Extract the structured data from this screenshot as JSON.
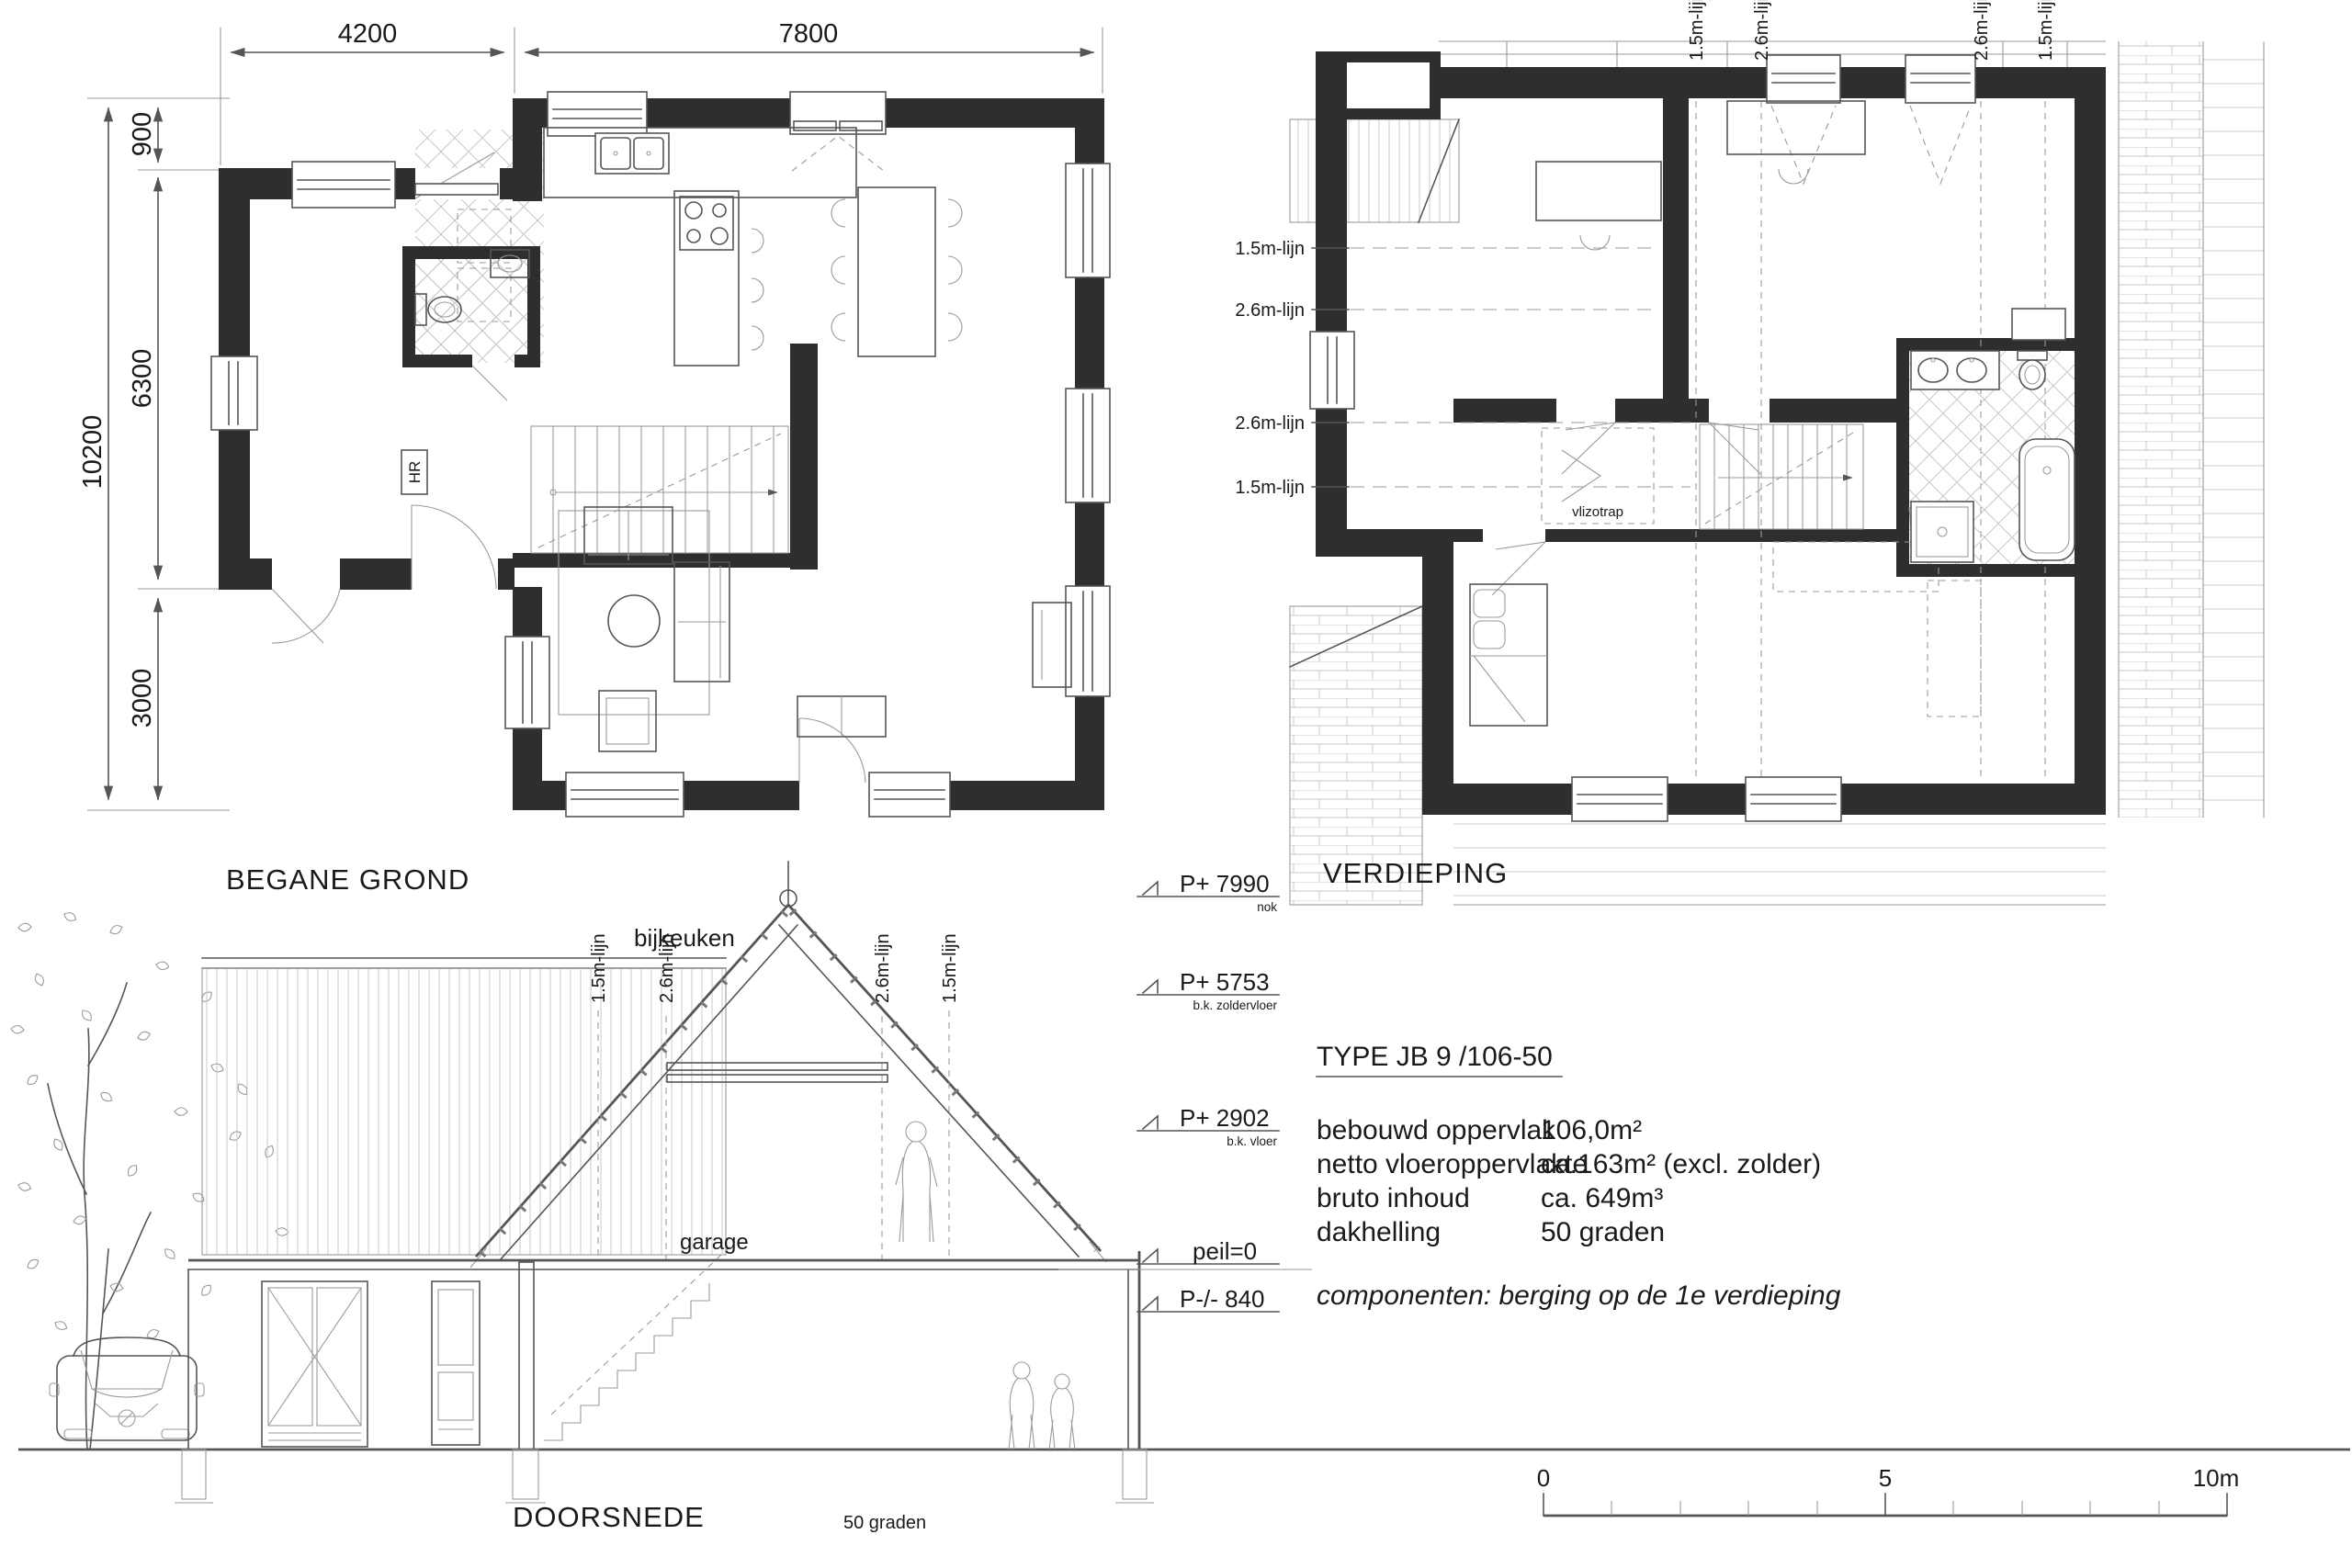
{
  "ground_floor": {
    "title": "BEGANE GROND",
    "dim_top_left": "4200",
    "dim_top_right": "7800",
    "dim_left_total": "10200",
    "dim_left_segments": [
      "900",
      "6300",
      "3000"
    ],
    "hr_label": "HR"
  },
  "first_floor": {
    "title": "VERDIEPING",
    "vlizotrap_label": "vlizotrap",
    "line_labels_left": [
      "1.5m-lijn",
      "2.6m-lijn",
      "2.6m-lijn",
      "1.5m-lijn"
    ],
    "line_labels_top": [
      "1.5m-lijn",
      "2.6m-lijn",
      "2.6m-lijn",
      "1.5m-lijn"
    ]
  },
  "section": {
    "title": "DOORSNEDE",
    "bijkeuken_label": "bijkeuken",
    "garage_label": "garage",
    "roof_pitch_label": "50 graden",
    "line_labels": [
      "1.5m-lijn",
      "2.6m-lijn",
      "2.6m-lijn",
      "1.5m-lijn"
    ]
  },
  "elevation_markers": [
    {
      "value": "P+ 7990",
      "sub": "nok"
    },
    {
      "value": "P+ 5753",
      "sub": "b.k. zoldervloer"
    },
    {
      "value": "P+ 2902",
      "sub": "b.k. vloer"
    },
    {
      "value": "peil=0",
      "sub": ""
    },
    {
      "value": "P-/- 840",
      "sub": ""
    }
  ],
  "specs": {
    "type_title": "TYPE JB 9 /106-50",
    "rows": [
      {
        "label": "bebouwd oppervlak",
        "value": "106,0m²"
      },
      {
        "label": "netto vloeroppervlakte",
        "value": "ca.163m² (excl. zolder)"
      },
      {
        "label": "bruto inhoud",
        "value": "ca. 649m³"
      },
      {
        "label": "dakhelling",
        "value": "50 graden"
      }
    ],
    "components_note": "componenten: berging op de 1e verdieping"
  },
  "scale_bar": {
    "start": "0",
    "middle": "5",
    "end": "10m"
  },
  "colors": {
    "wall": "#2e2e2e",
    "line": "#555555",
    "light_line": "#9a9a9a",
    "hatch": "#c9c9c9",
    "text": "#1a1a1a"
  }
}
